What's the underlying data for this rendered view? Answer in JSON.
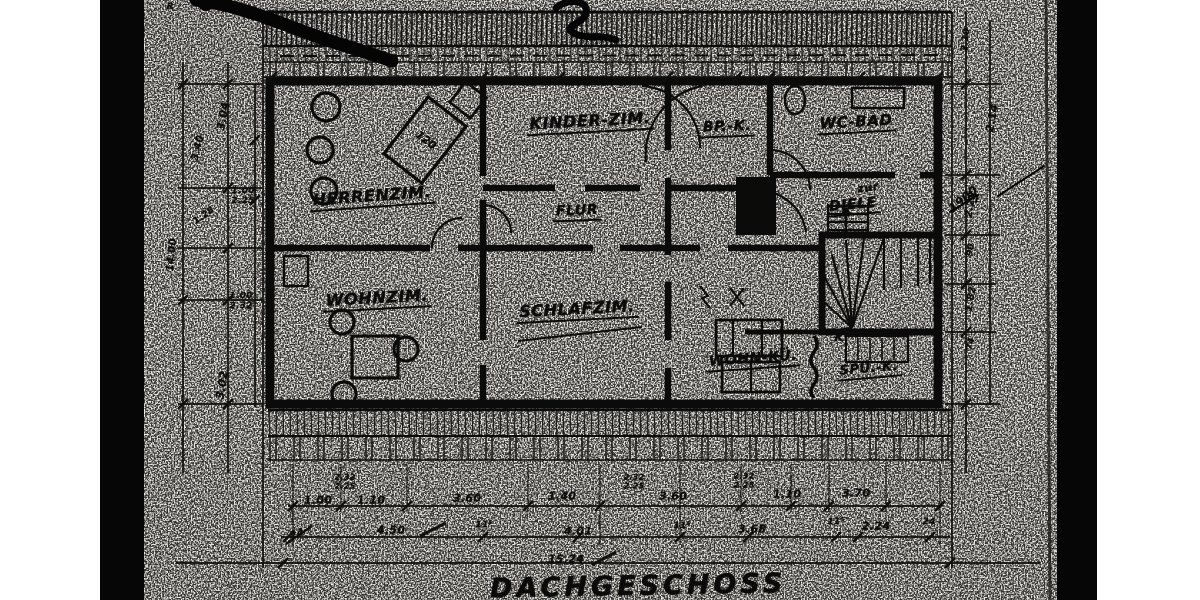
{
  "palette": {
    "ink": "#0c0c0b",
    "paper": "#f3f1ea",
    "scan_band": "#060606"
  },
  "title": {
    "text": "DACHGESCHOSS"
  },
  "rooms": {
    "herrenzim": "HERRENZIM.",
    "kinderzim": "KINDER-ZIM.",
    "bpk": "BP.-K.",
    "wcbad": "WC-BAD",
    "diele_line1": "zur",
    "diele_line2": "DIELE",
    "flur": "FLUR",
    "wohnzim": "WOHNZIM.",
    "schlafzim": "SCHLAFZIM.",
    "wohnku": "WOHN-KÜ.",
    "spuk": "SPÜ.-K."
  },
  "markers": {
    "k": "K",
    "bed_dim": "120",
    "r": "R",
    "year": "1900"
  },
  "dimensions": {
    "total": "15.24",
    "texts": [
      {
        "v": "1.00",
        "x": 318,
        "y": 500
      },
      {
        "v": "1.10",
        "x": 371,
        "y": 500
      },
      {
        "v": "3.60",
        "x": 467,
        "y": 498
      },
      {
        "v": "1.40",
        "x": 562,
        "y": 496
      },
      {
        "v": "3.60",
        "x": 673,
        "y": 496
      },
      {
        "v": "1.10",
        "x": 787,
        "y": 494
      },
      {
        "v": "3.70",
        "x": 856,
        "y": 493
      },
      {
        "v": "24",
        "x": 297,
        "y": 534,
        "r": -18,
        "s": 10
      },
      {
        "v": "4.50",
        "x": 391,
        "y": 530
      },
      {
        "v": "11⁵",
        "x": 484,
        "y": 525,
        "s": 9
      },
      {
        "v": "4.01",
        "x": 578,
        "y": 531
      },
      {
        "v": "11⁵",
        "x": 682,
        "y": 526,
        "s": 9
      },
      {
        "v": "3.68",
        "x": 752,
        "y": 529
      },
      {
        "v": "11⁵",
        "x": 836,
        "y": 522,
        "s": 9
      },
      {
        "v": "2.24",
        "x": 876,
        "y": 526
      },
      {
        "v": "24",
        "x": 929,
        "y": 522,
        "s": 9
      },
      {
        "v": "15.24",
        "x": 566,
        "y": 559
      },
      {
        "v": "2.32",
        "x": 345,
        "y": 477,
        "s": 8
      },
      {
        "v": "2.25",
        "x": 345,
        "y": 486,
        "s": 8
      },
      {
        "v": "2.32",
        "x": 634,
        "y": 477,
        "s": 8
      },
      {
        "v": "2.25",
        "x": 634,
        "y": 486,
        "s": 8
      },
      {
        "v": "2.32",
        "x": 744,
        "y": 476,
        "s": 8
      },
      {
        "v": "2.25",
        "x": 744,
        "y": 485,
        "s": 8
      },
      {
        "v": "3.04",
        "x": 223,
        "y": 116,
        "r": -80
      },
      {
        "v": "3.40",
        "x": 198,
        "y": 148,
        "r": -76,
        "s": 10
      },
      {
        "v": "1.00",
        "x": 243,
        "y": 191,
        "s": 9
      },
      {
        "v": "2.25",
        "x": 243,
        "y": 201,
        "s": 9
      },
      {
        "v": "1.00",
        "x": 241,
        "y": 296,
        "s": 9
      },
      {
        "v": "2.32",
        "x": 241,
        "y": 306,
        "s": 9
      },
      {
        "v": "3.02",
        "x": 222,
        "y": 385,
        "r": -80
      },
      {
        "v": "14.00",
        "x": 172,
        "y": 255,
        "r": -84,
        "s": 10
      },
      {
        "v": "1.28",
        "x": 204,
        "y": 216,
        "r": -35,
        "s": 9
      },
      {
        "v": "2.10",
        "x": 966,
        "y": 40,
        "r": -84,
        "s": 9
      },
      {
        "v": "2.14",
        "x": 992,
        "y": 118,
        "r": -80
      },
      {
        "v": "2.28",
        "x": 971,
        "y": 205,
        "r": -80,
        "s": 10
      },
      {
        "v": "90",
        "x": 971,
        "y": 250,
        "r": -80,
        "s": 9
      },
      {
        "v": "1.82",
        "x": 971,
        "y": 299,
        "r": -80,
        "s": 10
      },
      {
        "v": "74",
        "x": 971,
        "y": 344,
        "r": -80,
        "s": 9
      }
    ]
  }
}
